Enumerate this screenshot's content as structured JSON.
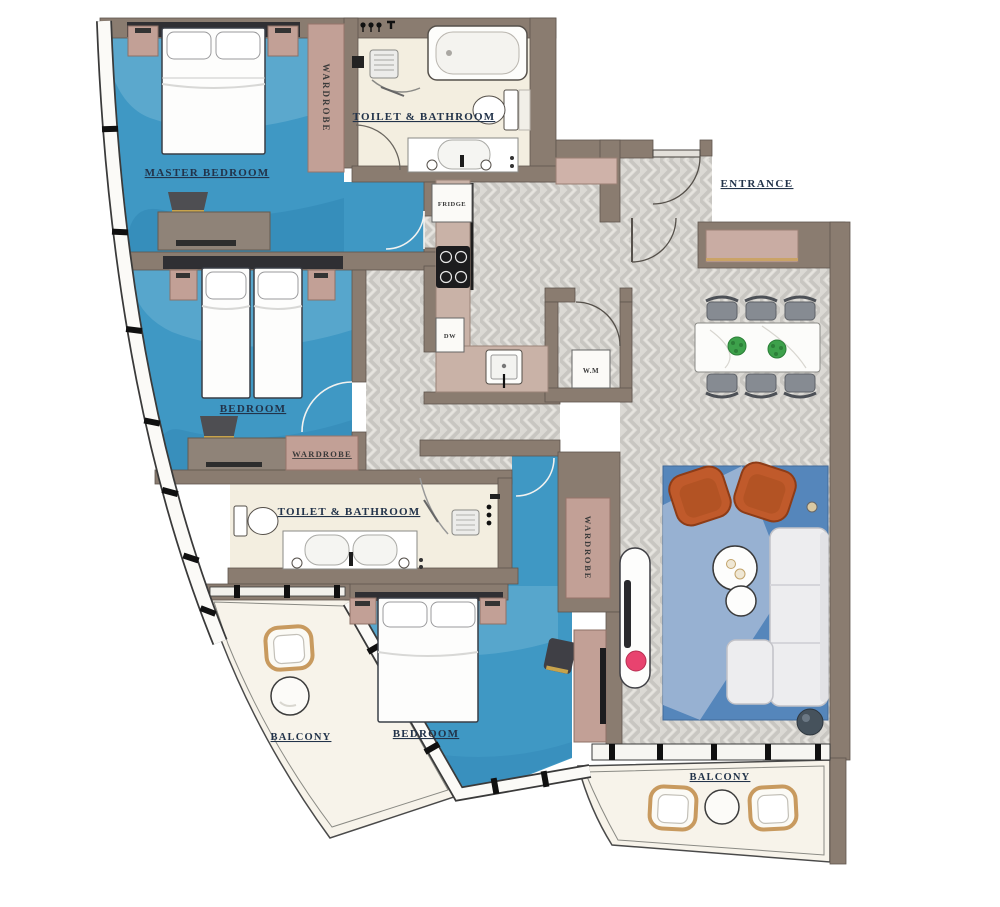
{
  "floor_plan": {
    "labels": {
      "master_bedroom": "MASTER BEDROOM",
      "wardrobe_master": "WARDROBE",
      "bathroom_top": "TOILET & BATHROOM",
      "entrance": "ENTRANCE",
      "fridge": "FRIDGE",
      "dishwasher": "DW",
      "washing_machine": "W.M",
      "bedroom_mid": "BEDROOM",
      "wardrobe_mid": "WARDROBE",
      "bathroom_mid": "TOILET & BATHROOM",
      "wardrobe_living": "WARDROBE",
      "bedroom_bottom": "BEDROOM",
      "balcony_left": "BALCONY",
      "balcony_right": "BALCONY"
    },
    "colors": {
      "wall_taupe": "#8a7c70",
      "carpet_blue": "#3f98c4",
      "bathroom_cream": "#f3eee0",
      "tile_gray": "#dbd9d4",
      "furniture_pink": "#c2a096",
      "counter_pink": "#c9b2a7",
      "armchair_orange": "#c05a2b",
      "rug_blue": "#5586bb",
      "accent_pink": "#e8436f",
      "plant_green": "#3da14b",
      "label_ink": "#22334a"
    }
  }
}
